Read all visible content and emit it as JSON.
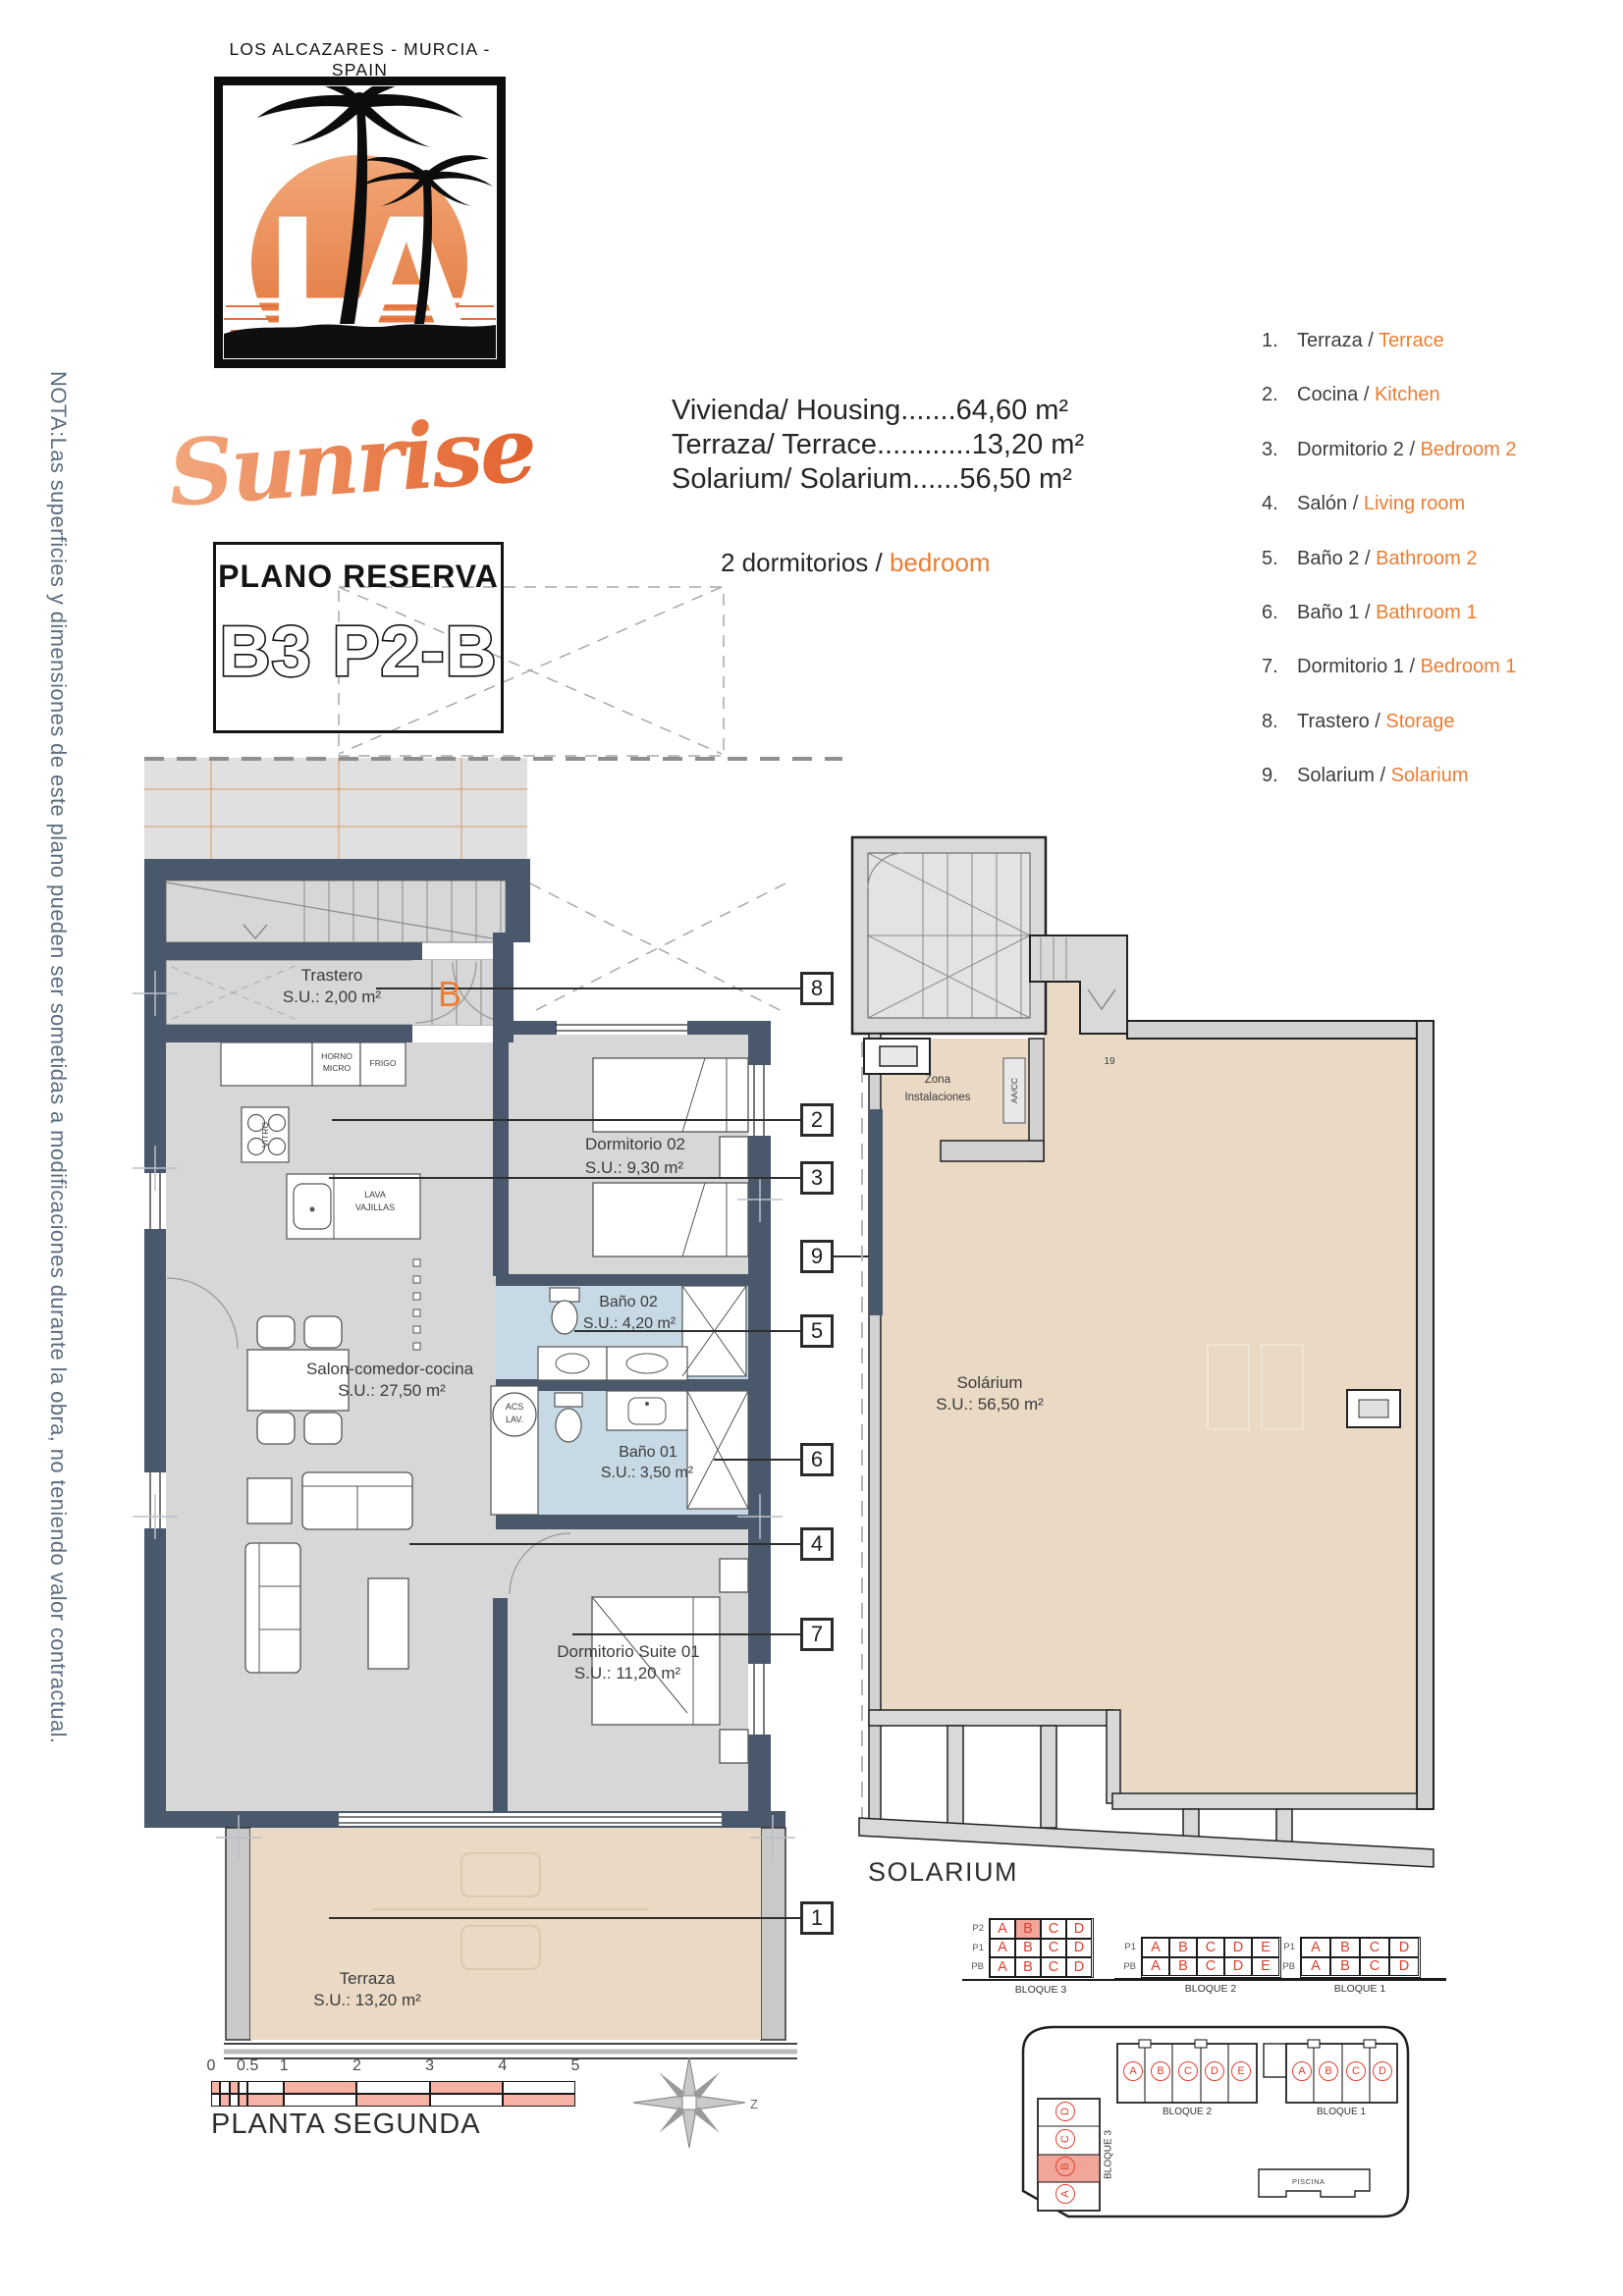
{
  "note_vertical": "NOTA:Las superficies y dimensiones de este plano pueden ser sometidas a modificaciones durante la obra, no teniendo valor contractual.",
  "header": {
    "location": "LOS ALCAZARES - MURCIA - SPAIN",
    "brand": "Sunrise",
    "logo_letters": "LA"
  },
  "reserve": {
    "title": "PLANO RESERVA",
    "code": "B3 P2-B"
  },
  "measurements": {
    "lines": [
      "Vivienda/ Housing.......64,60 m²",
      "Terraza/ Terrace............13,20 m²",
      "Solarium/ Solarium......56,50 m²"
    ],
    "bedrooms_es": "2 dormitorios /",
    "bedrooms_en": "bedroom"
  },
  "legend": {
    "items": [
      {
        "num": "1.",
        "es": "Terraza",
        "en": "Terrace"
      },
      {
        "num": "2.",
        "es": "Cocina",
        "en": "Kitchen"
      },
      {
        "num": "3.",
        "es": "Dormitorio 2",
        "en": "Bedroom 2"
      },
      {
        "num": "4.",
        "es": "Salón",
        "en": "Living room"
      },
      {
        "num": "5.",
        "es": "Baño 2",
        "en": "Bathroom 2"
      },
      {
        "num": "6.",
        "es": "Baño 1",
        "en": "Bathroom 1"
      },
      {
        "num": "7.",
        "es": "Dormitorio 1",
        "en": "Bedroom 1"
      },
      {
        "num": "8.",
        "es": "Trastero",
        "en": "Storage"
      },
      {
        "num": "9.",
        "es": "Solarium",
        "en": "Solarium"
      }
    ]
  },
  "plan": {
    "trastero_name": "Trastero",
    "trastero_area": "S.U.: 2,00 m²",
    "unit_letter": "B",
    "dorm2_name": "Dormitorio 02",
    "dorm2_area": "S.U.: 9,30 m²",
    "bath2_name": "Baño 02",
    "bath2_area": "S.U.: 4,20 m²",
    "bath1_name": "Baño 01",
    "bath1_area": "S.U.: 3,50 m²",
    "salon_name": "Salon-comedor-cocina",
    "salon_area": "S.U.: 27,50 m²",
    "suite_name": "Dormitorio Suite 01",
    "suite_area": "S.U.: 11,20 m²",
    "terrace_name": "Terraza",
    "terrace_area": "S.U.: 13,20 m²",
    "appliances": {
      "horno1": "HORNO",
      "horno2": "MICRO",
      "frigo": "FRIGO",
      "vitro": "VITRO",
      "lava1": "LAVA",
      "lava2": "VAJILLAS",
      "acs1": "ACS",
      "acs2": "LAV."
    },
    "callouts": [
      "8",
      "2",
      "3",
      "9",
      "5",
      "6",
      "4",
      "7",
      "1"
    ]
  },
  "solarium_plan": {
    "zona1": "Zona",
    "zona2": "Instalaciones",
    "aacc": "AA/CC",
    "num": "19",
    "name": "Solárium",
    "area": "S.U.: 56,50 m²",
    "title": "SOLARIUM"
  },
  "footer": {
    "floor_title": "PLANTA SEGUNDA",
    "scale_ticks": [
      "0",
      "0.5",
      "1",
      "2",
      "3",
      "4",
      "5"
    ],
    "compass_label": "Z"
  },
  "blocks": {
    "bloque3": {
      "name": "BLOQUE 3",
      "rows": [
        {
          "label": "P2",
          "cells": [
            "A",
            "B",
            "C",
            "D"
          ],
          "highlight": 1
        },
        {
          "label": "P1",
          "cells": [
            "A",
            "B",
            "C",
            "D"
          ],
          "highlight": -1
        },
        {
          "label": "PB",
          "cells": [
            "A",
            "B",
            "C",
            "D"
          ],
          "highlight": -1
        }
      ]
    },
    "bloque2": {
      "name": "BLOQUE 2",
      "rows": [
        {
          "label": "P1",
          "cells": [
            "A",
            "B",
            "C",
            "D",
            "E"
          ],
          "highlight": -1
        },
        {
          "label": "PB",
          "cells": [
            "A",
            "B",
            "C",
            "D",
            "E"
          ],
          "highlight": -1
        }
      ]
    },
    "bloque1": {
      "name": "BLOQUE 1",
      "rows": [
        {
          "label": "P1",
          "cells": [
            "A",
            "B",
            "C",
            "D"
          ],
          "highlight": -1
        },
        {
          "label": "PB",
          "cells": [
            "A",
            "B",
            "C",
            "D"
          ],
          "highlight": -1
        }
      ]
    }
  },
  "site": {
    "bloque2": {
      "name": "BLOQUE 2",
      "units": [
        "A",
        "B",
        "C",
        "D",
        "E"
      ]
    },
    "bloque1": {
      "name": "BLOQUE 1",
      "units": [
        "A",
        "B",
        "C",
        "D"
      ]
    },
    "bloque3": {
      "name": "BLOQUE 3",
      "units": [
        "D",
        "C",
        "B",
        "A"
      ],
      "highlight": "B"
    },
    "piscina": "PISCINA"
  },
  "colors": {
    "accent": "#ED7D31",
    "wall": "#4a586c",
    "room": "#d7d7d7",
    "bath": "#c6d9e5",
    "beige": "#ead9c5",
    "red": "#E0402F",
    "salmon": "#F2A699",
    "scale_salmon": "#F5B2A5"
  }
}
